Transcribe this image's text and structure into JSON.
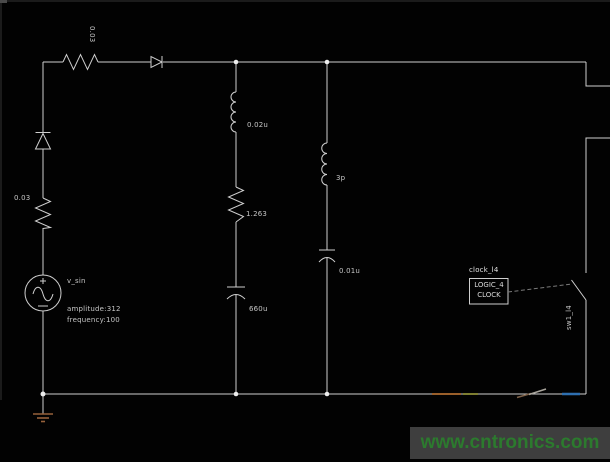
{
  "schematic": {
    "source": {
      "name": "v_sin",
      "amplitude": "amplitude:312",
      "frequency": "frequency:100"
    },
    "series_resistor_value": "0.03",
    "left_resistor_value": "0.03",
    "mid_inductor_value": "0.02u",
    "mid_resistor_value": "1.263",
    "mid_capacitor_value": "660u",
    "right_inductor_value": "3p",
    "right_capacitor_value": "0.01u",
    "clock": {
      "ref": "clock_l4",
      "type_line1": "LOGIC_4",
      "type_line2": "CLOCK"
    },
    "switch_ref": "sw1_l4",
    "colors": {
      "wire": "#cfcfcf",
      "label": "#c6c6c6",
      "ground": "#96613b",
      "highlight_orange": "#9a5f2a",
      "highlight_olive": "#7e7e30",
      "highlight_blue": "#2e6fb0"
    }
  },
  "watermark": {
    "text": "www.cntronics.com",
    "bg": "#3e3e3e",
    "color": "#2c7a2e"
  }
}
